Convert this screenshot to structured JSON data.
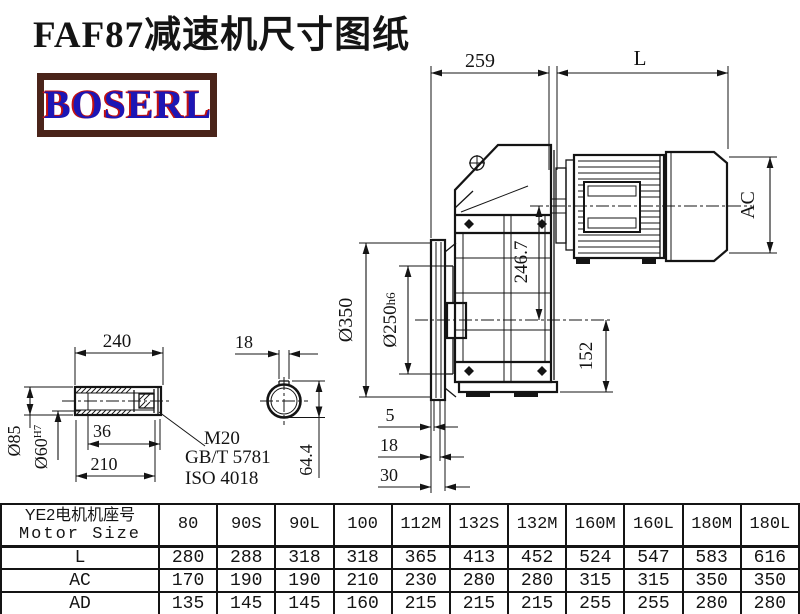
{
  "title": "FAF87减速机尺寸图纸",
  "logo": {
    "text": "BOSERL"
  },
  "colors": {
    "ink": "#141414",
    "logo_text": "#1c16b5",
    "logo_shadow": "#c41111",
    "logo_border": "#4a241a"
  },
  "drawing": {
    "dim_259": "259",
    "dim_L": "L",
    "dim_AC": "AC",
    "dim_246_7": "246.7",
    "dim_flange_od": "Ø350",
    "dim_spigot": "Ø250",
    "dim_spigot_tol": "h6",
    "dim_152": "152",
    "dim_5": "5",
    "dim_18": "18",
    "dim_30": "30",
    "shaft": {
      "dim_240": "240",
      "dim_od": "Ø85",
      "dim_bore": "Ø60",
      "dim_bore_tol": "H7",
      "dim_36": "36",
      "dim_210": "210",
      "bolt": "M20",
      "std_gb": "GB/T 5781",
      "std_iso": "ISO 4018",
      "key_width": "18",
      "key_depth": "64.4"
    }
  },
  "table": {
    "header_line1": "YE2电机机座号",
    "header_line2": "Motor Size",
    "columns": [
      "80",
      "90S",
      "90L",
      "100",
      "112M",
      "132S",
      "132M",
      "160M",
      "160L",
      "180M",
      "180L"
    ],
    "rows": [
      {
        "label": "L",
        "values": [
          "280",
          "288",
          "318",
          "318",
          "365",
          "413",
          "452",
          "524",
          "547",
          "583",
          "616"
        ]
      },
      {
        "label": "AC",
        "values": [
          "170",
          "190",
          "190",
          "210",
          "230",
          "280",
          "280",
          "315",
          "315",
          "350",
          "350"
        ]
      },
      {
        "label": "AD",
        "values": [
          "135",
          "145",
          "145",
          "160",
          "215",
          "215",
          "215",
          "255",
          "255",
          "280",
          "280"
        ]
      }
    ]
  }
}
